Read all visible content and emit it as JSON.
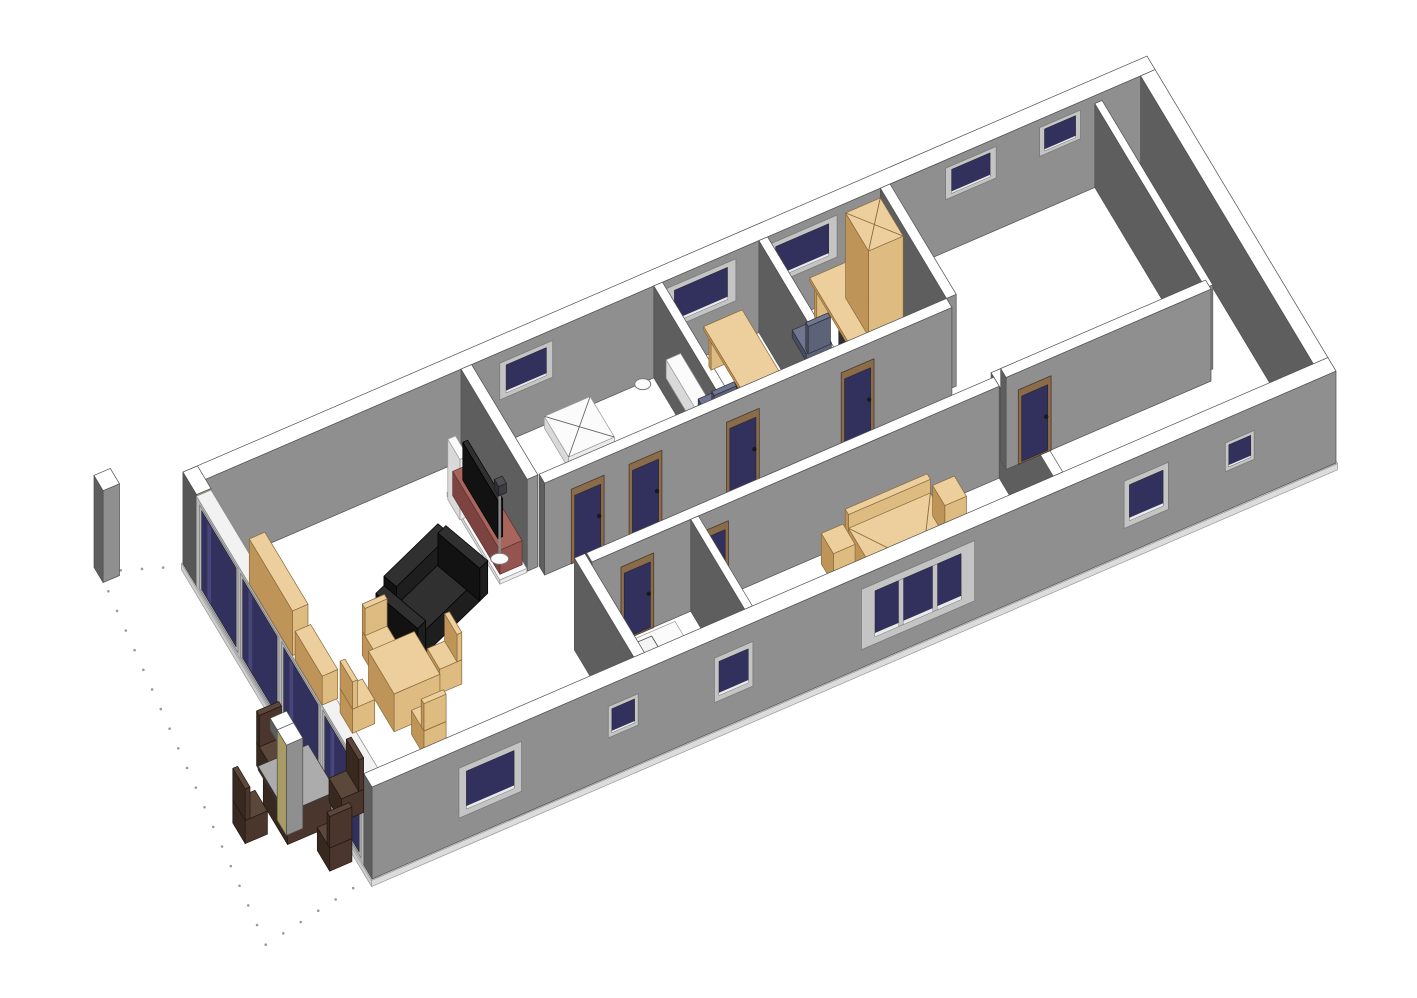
{
  "meta": {
    "title": "3D Axonometric Floor Plan View",
    "background": "#ffffff"
  },
  "projection": {
    "origin": [
      183,
      564
    ],
    "ux": [
      48.2,
      -20.8
    ],
    "uy": [
      27,
      45
    ],
    "uz": 52.5
  },
  "palette": {
    "wall": {
      "t": "#ffffff",
      "f": "#8f8f8f",
      "s": "#5e5e5e",
      "e": "#4f4f4f"
    },
    "glassFrame": {
      "t": "#f2f2f2",
      "f": "#c2c2c2",
      "s": "#b6b6b6",
      "e": "#8a8a8a"
    },
    "floorp": {
      "t": "#ffffff",
      "f": "#dcdcdc",
      "s": "#cccccc",
      "e": "#999999"
    },
    "tan": {
      "t": "#eccf9d",
      "f": "#debb80",
      "s": "#bf9458",
      "e": "#8a6a3a"
    },
    "white": {
      "t": "#fbfbfb",
      "f": "#ebebeb",
      "s": "#d9d9d9",
      "e": "#9a9a9a"
    },
    "red": {
      "t": "#a8655c",
      "f": "#95544d",
      "s": "#7d4340",
      "e": "#5e312e"
    },
    "blackp": {
      "t": "#303030",
      "f": "#1e1e1e",
      "s": "#121212",
      "e": "#000000"
    },
    "wood": {
      "t": "#5c473b",
      "f": "#4a362c",
      "s": "#372820",
      "e": "#241812"
    },
    "woodTop": {
      "t": "#acacac",
      "f": "#4a362c",
      "s": "#372820",
      "e": "#3a3a3a"
    },
    "chairc": {
      "t": "#707690",
      "f": "#5c6278",
      "s": "#474c5e",
      "e": "#2c2f3a"
    },
    "dark": {
      "t": "#4e4e54",
      "f": "#3c3c42",
      "s": "#2e2e33",
      "e": "#1e1e22"
    },
    "pillarTan": {
      "t": "#ffffff",
      "f": "#a89b63",
      "s": "#565656",
      "e": "#4f4f4f"
    },
    "colTan": {
      "t": "#ffffff",
      "f": "#8f8f8f",
      "s": "#a89b63",
      "e": "#4f4f4f"
    }
  },
  "materials": {
    "glass": "#32305c",
    "glassHi": "#474579",
    "windowFrame": "#c4c4c4",
    "windowFrameEdge": "#7a7a7a",
    "sill": "#e9e9e9",
    "doorFrame": "#8a6b4a",
    "doorFrameEdge": "#4a3a28",
    "doorPanel": "#32305c",
    "handle": "#1a1a1a",
    "dot": "#9a9a9a",
    "topLine": "#8a6a3a",
    "showerLine": "#666666",
    "chairBase": "#2e2e2e"
  },
  "scene": [
    {
      "t": "dots",
      "n": "terrace-boundary",
      "pts": [
        [
          0,
          0.05
        ],
        [
          -1.45,
          -0.5
        ],
        [
          -2.4,
          7.35
        ],
        [
          0,
          6.95
        ]
      ]
    },
    {
      "t": "box",
      "n": "floor-slab",
      "p": [
        -0.02,
        -0.02,
        20.04,
        7.04,
        -0.12,
        0.12
      ],
      "c": "floorp"
    },
    {
      "t": "box",
      "n": "back-wall",
      "p": [
        0,
        0,
        20,
        0.3,
        0,
        1.75
      ],
      "c": "wall"
    },
    {
      "t": "win",
      "n": "window-bathroom",
      "p": [
        6.4,
        1.1,
        0.85,
        0.7
      ],
      "y": 0.305
    },
    {
      "t": "win",
      "n": "window-bedroom-1",
      "p": [
        9.85,
        1.45,
        0.8,
        0.8
      ],
      "y": 0.305
    },
    {
      "t": "win",
      "n": "window-bedroom-2",
      "p": [
        11.95,
        1.45,
        0.8,
        0.8
      ],
      "y": 0.305
    },
    {
      "t": "win",
      "n": "window-garage-rear-1",
      "p": [
        15.65,
        1.05,
        1.0,
        0.6
      ],
      "y": 0.305
    },
    {
      "t": "win",
      "n": "window-garage-rear-2",
      "p": [
        17.6,
        0.85,
        1.05,
        0.55
      ],
      "y": 0.305
    },
    {
      "t": "box",
      "n": "right-end-wall",
      "p": [
        19.7,
        0.3,
        0.3,
        6.4,
        0,
        1.75
      ],
      "c": "wall"
    },
    {
      "t": "box",
      "n": "left-corner-pillar",
      "p": [
        0,
        0,
        0.3,
        0.5,
        0,
        1.75
      ],
      "c": "pillarTan"
    },
    {
      "t": "box",
      "n": "left-glass-wall",
      "p": [
        0,
        0.5,
        0.3,
        6.2,
        0,
        1.72
      ],
      "c": "glassFrame"
    },
    {
      "t": "glass",
      "n": "sliding-glass-panel-1",
      "p": [
        0.62,
        1.42,
        0.06,
        1.6
      ],
      "x": -0.002
    },
    {
      "t": "glass",
      "n": "sliding-glass-panel-2",
      "p": [
        2.14,
        1.42,
        0.06,
        1.6
      ],
      "x": -0.002
    },
    {
      "t": "glass",
      "n": "sliding-glass-panel-3",
      "p": [
        3.66,
        1.42,
        0.06,
        1.6
      ],
      "x": -0.002
    },
    {
      "t": "glass",
      "n": "sliding-glass-panel-4",
      "p": [
        5.18,
        1.42,
        0.06,
        1.6
      ],
      "x": -0.002
    },
    {
      "t": "box",
      "n": "living-sideboard-1",
      "p": [
        0.9,
        0.85,
        0.32,
        1.6,
        0,
        0.85
      ],
      "c": "tan"
    },
    {
      "t": "box",
      "n": "living-sideboard-2",
      "p": [
        0.9,
        2.55,
        0.32,
        1.0,
        0,
        0.55
      ],
      "c": "tan"
    },
    {
      "t": "box",
      "n": "shower-tray",
      "p": [
        7.3,
        0.35,
        0.95,
        0.9,
        0,
        0.22
      ],
      "c": "white",
      "top": "cross"
    },
    {
      "t": "box",
      "n": "toilet-tank",
      "p": [
        7.75,
        2.42,
        0.42,
        0.2,
        0,
        0.52
      ],
      "c": "white"
    },
    {
      "t": "ell",
      "n": "toilet-bowl",
      "p": [
        7.95,
        2.15,
        0.3,
        10,
        6.5
      ]
    },
    {
      "t": "ell",
      "n": "bathroom-sink",
      "p": [
        8.95,
        1.05,
        0.78,
        8,
        5.5
      ]
    },
    {
      "t": "box",
      "n": "wall-bath-bedroom1",
      "p": [
        9.6,
        0.3,
        0.18,
        2.45,
        0,
        1.75
      ],
      "c": "wall"
    },
    {
      "t": "box",
      "n": "bedroom1-cabinet",
      "p": [
        9.8,
        0.4,
        0.3,
        1.05,
        0,
        0.35
      ],
      "c": "white"
    },
    {
      "t": "box",
      "n": "bedroom1-desk-panel",
      "p": [
        10.62,
        0.52,
        0.62,
        0.08,
        0,
        0.66
      ],
      "c": "tan"
    },
    {
      "t": "box",
      "n": "bedroom1-desk-drawers",
      "p": [
        10.62,
        1.5,
        0.62,
        0.5,
        0,
        0.66
      ],
      "c": "dark"
    },
    {
      "t": "box",
      "n": "bedroom1-desk-top",
      "p": [
        10.55,
        0.45,
        0.8,
        1.6,
        0.66,
        0.07
      ],
      "c": "tan"
    },
    {
      "t": "ochair",
      "n": "bedroom1-office-chair",
      "p": [
        9.82,
        1.55
      ]
    },
    {
      "t": "box",
      "n": "bedroom1-dresser",
      "p": [
        10.62,
        2.1,
        0.55,
        0.55,
        0,
        0.85
      ],
      "c": "tan",
      "top": "cross"
    },
    {
      "t": "box",
      "n": "wall-bedroom1-bedroom2",
      "p": [
        11.78,
        0.3,
        0.18,
        2.45,
        0,
        1.75
      ],
      "c": "wall"
    },
    {
      "t": "box",
      "n": "bedroom2-desk-panel",
      "p": [
        12.85,
        0.45,
        0.62,
        0.08,
        0,
        0.66
      ],
      "c": "tan"
    },
    {
      "t": "box",
      "n": "bedroom2-desk-drawers",
      "p": [
        12.85,
        1.35,
        0.62,
        0.5,
        0,
        0.66
      ],
      "c": "dark"
    },
    {
      "t": "box",
      "n": "bedroom2-desk-top",
      "p": [
        12.78,
        0.4,
        0.78,
        1.5,
        0.66,
        0.07
      ],
      "c": "tan"
    },
    {
      "t": "ochair",
      "n": "bedroom2-office-chair",
      "p": [
        12.05,
        1.05
      ]
    },
    {
      "t": "box",
      "n": "bedroom2-bed",
      "p": [
        12.15,
        1.95,
        1.5,
        0.72,
        0,
        0.4
      ],
      "c": "white"
    },
    {
      "t": "box",
      "n": "bedroom2-bed-headboard",
      "p": [
        13.5,
        1.95,
        0.15,
        0.72,
        0.4,
        0.22
      ],
      "c": "white"
    },
    {
      "t": "box",
      "n": "wall-bedroom2-garage",
      "p": [
        14.3,
        0.3,
        0.2,
        2.45,
        0,
        1.75
      ],
      "c": "wall"
    },
    {
      "t": "box",
      "n": "wall-entry-left",
      "p": [
        14.3,
        4.4,
        0.2,
        2.3,
        0,
        1.75
      ],
      "c": "wall"
    },
    {
      "t": "box",
      "n": "bedroom2-wardrobe",
      "p": [
        13.55,
        0.35,
        0.72,
        0.85,
        0,
        1.62
      ],
      "c": "tan",
      "top": "cross"
    },
    {
      "t": "box",
      "n": "garage-inner-wall",
      "p": [
        18.75,
        0.3,
        0.15,
        4.1,
        0,
        1.6
      ],
      "c": "wall"
    },
    {
      "t": "box",
      "n": "hallway-wall-rear",
      "p": [
        5.85,
        2.75,
        8.45,
        0.2,
        0,
        1.75
      ],
      "c": "wall"
    },
    {
      "t": "door",
      "n": "door-living",
      "p": [
        6.4,
        0.68,
        0,
        1.42
      ],
      "y": 2.956
    },
    {
      "t": "door",
      "n": "door-bathroom",
      "p": [
        7.6,
        0.68,
        0,
        1.42
      ],
      "y": 2.956
    },
    {
      "t": "door",
      "n": "door-bedroom-1",
      "p": [
        9.62,
        0.68,
        0,
        1.42
      ],
      "y": 2.956
    },
    {
      "t": "door",
      "n": "door-bedroom-2",
      "p": [
        12.0,
        0.68,
        0,
        1.42
      ],
      "y": 2.956
    },
    {
      "t": "box",
      "n": "hallway-wall-front",
      "p": [
        5.85,
        4.5,
        8.45,
        0.2,
        0,
        1.75
      ],
      "c": "wall"
    },
    {
      "t": "door",
      "n": "door-kitchen",
      "p": [
        6.45,
        0.68,
        0,
        1.42
      ],
      "y": 4.706
    },
    {
      "t": "door",
      "n": "door-master-bedroom",
      "p": [
        8.0,
        0.68,
        0,
        1.42
      ],
      "y": 4.706
    },
    {
      "t": "box",
      "n": "entry-wall",
      "p": [
        14.5,
        4.4,
        4.25,
        0.2,
        0,
        1.75
      ],
      "c": "wall"
    },
    {
      "t": "door",
      "n": "door-garage",
      "p": [
        14.75,
        0.68,
        0,
        1.42
      ],
      "y": 4.606
    },
    {
      "t": "box",
      "n": "wall-kitchen-master",
      "p": [
        7.9,
        4.7,
        0.16,
        2.0,
        0,
        1.75
      ],
      "c": "wall"
    },
    {
      "t": "box",
      "n": "master-bed-headboard",
      "p": [
        11.05,
        4.8,
        1.7,
        0.12,
        0,
        0.78
      ],
      "c": "tan"
    },
    {
      "t": "box",
      "n": "master-bed",
      "p": [
        11.05,
        4.92,
        1.7,
        1.95,
        0,
        0.52
      ],
      "c": "tan",
      "top": "bed"
    },
    {
      "t": "box",
      "n": "nightstand-left",
      "p": [
        10.52,
        4.86,
        0.45,
        0.45,
        0,
        0.58
      ],
      "c": "tan"
    },
    {
      "t": "box",
      "n": "nightstand-right",
      "p": [
        12.83,
        4.86,
        0.45,
        0.45,
        0,
        0.58
      ],
      "c": "tan"
    },
    {
      "t": "box",
      "n": "kitchen-counter",
      "p": [
        5.95,
        5.28,
        1.3,
        0.58,
        0,
        0.56
      ],
      "c": "white"
    },
    {
      "t": "sink",
      "n": "kitchen-sink",
      "p": [
        6.12,
        5.36,
        0.6,
        0.42,
        0.56
      ]
    },
    {
      "t": "box",
      "n": "wall-living-rear-seg",
      "p": [
        5.6,
        0.3,
        0.22,
        2.45,
        0,
        1.75
      ],
      "c": "wall"
    },
    {
      "t": "box",
      "n": "wall-living-front-seg",
      "p": [
        5.6,
        4.5,
        0.22,
        2.2,
        0,
        1.75
      ],
      "c": "wall"
    },
    {
      "t": "box",
      "n": "tv-base",
      "p": [
        5.02,
        0.82,
        0.56,
        1.95,
        0,
        0.08
      ],
      "c": "white"
    },
    {
      "t": "box",
      "n": "tv-speaker",
      "p": [
        5.0,
        0.88,
        0.16,
        0.45,
        0,
        1.15
      ],
      "c": "white"
    },
    {
      "t": "box",
      "n": "tv-cabinet",
      "p": [
        5.08,
        0.92,
        0.46,
        1.75,
        0.08,
        0.46
      ],
      "c": "red"
    },
    {
      "t": "box",
      "n": "tv-screen",
      "p": [
        5.16,
        1.15,
        0.1,
        1.3,
        0.54,
        0.72
      ],
      "c": "blackp"
    },
    {
      "t": "pole",
      "n": "floor-lamp-pole",
      "p": [
        5.27,
        2.32,
        1.3
      ]
    },
    {
      "t": "ell",
      "n": "floor-lamp-base",
      "p": [
        5.27,
        2.32,
        0,
        9,
        5.5
      ]
    },
    {
      "t": "box",
      "n": "floor-lamp-head",
      "p": [
        5.2,
        2.25,
        0.16,
        0.16,
        1.3,
        0.18
      ],
      "c": "dark"
    },
    {
      "t": "box",
      "n": "sofa-back",
      "p": [
        2.9,
        2.2,
        1.5,
        0.3,
        0,
        0.8
      ],
      "c": "blackp",
      "rot": -20,
      "pivot": [
        3.65,
        2.7
      ]
    },
    {
      "t": "box",
      "n": "sofa-seat",
      "p": [
        2.9,
        2.5,
        1.5,
        0.7,
        0,
        0.45
      ],
      "c": "blackp",
      "rot": -20,
      "pivot": [
        3.65,
        2.7
      ]
    },
    {
      "t": "box",
      "n": "sofa-arm-left",
      "p": [
        2.68,
        2.2,
        0.22,
        1.0,
        0,
        0.62
      ],
      "c": "blackp",
      "rot": -20,
      "pivot": [
        3.65,
        2.7
      ]
    },
    {
      "t": "box",
      "n": "sofa-arm-right",
      "p": [
        4.4,
        2.2,
        0.22,
        1.0,
        0,
        0.62
      ],
      "c": "blackp",
      "rot": -20,
      "pivot": [
        3.65,
        2.7
      ]
    },
    {
      "t": "chair",
      "n": "dining-chair-north",
      "p": [
        2.05,
        2.98
      ],
      "dir": "n",
      "c": "tan"
    },
    {
      "t": "chair",
      "n": "dining-chair-east",
      "p": [
        2.95,
        3.78
      ],
      "dir": "e",
      "c": "tan"
    },
    {
      "t": "box",
      "n": "dining-table",
      "p": [
        1.82,
        3.62,
        0.95,
        0.95,
        0,
        0.72
      ],
      "c": "tan"
    },
    {
      "t": "chair",
      "n": "dining-chair-west",
      "p": [
        1.12,
        3.82
      ],
      "dir": "w",
      "c": "tan"
    },
    {
      "t": "chair",
      "n": "dining-chair-south",
      "p": [
        2.08,
        4.75
      ],
      "dir": "s",
      "c": "tan"
    },
    {
      "t": "box",
      "n": "front-wall",
      "p": [
        0,
        6.7,
        20,
        0.3,
        0,
        1.75
      ],
      "c": "wall"
    },
    {
      "t": "win",
      "n": "window-living-front",
      "p": [
        1.8,
        1.3,
        0.45,
        0.95
      ],
      "y": 7.006
    },
    {
      "t": "win",
      "n": "window-living-front-2",
      "p": [
        4.9,
        0.62,
        0.75,
        0.6
      ],
      "y": 7.006
    },
    {
      "t": "win",
      "n": "window-kitchen-front",
      "p": [
        7.1,
        0.8,
        0.55,
        0.85
      ],
      "y": 7.006
    },
    {
      "t": "win",
      "n": "window-master-triple",
      "p": [
        10.15,
        2.35,
        0.35,
        1.15
      ],
      "y": 7.006,
      "k": 3
    },
    {
      "t": "win",
      "n": "window-entry-1",
      "p": [
        15.6,
        0.92,
        0.5,
        0.9
      ],
      "y": 7.006
    },
    {
      "t": "win",
      "n": "window-entry-2",
      "p": [
        17.7,
        0.6,
        0.75,
        0.55
      ],
      "y": 7.006
    },
    {
      "t": "box",
      "n": "terrace-column-rear",
      "p": [
        -1.5,
        -0.62,
        0.34,
        0.34,
        0,
        1.75
      ],
      "c": "wall"
    },
    {
      "t": "chair",
      "n": "patio-chair-north",
      "p": [
        -0.78,
        4.12
      ],
      "dir": "n",
      "c": "wood"
    },
    {
      "t": "chair",
      "n": "patio-chair-west",
      "p": [
        -1.74,
        4.95
      ],
      "dir": "w",
      "c": "wood"
    },
    {
      "t": "box",
      "n": "patio-table-base",
      "p": [
        -1.05,
        4.85,
        0.9,
        0.9,
        0,
        0.62
      ],
      "c": "wood"
    },
    {
      "t": "box",
      "n": "patio-table-top",
      "p": [
        -1.12,
        4.78,
        1.04,
        1.04,
        0.62,
        0.07
      ],
      "c": "woodTop"
    },
    {
      "t": "chair",
      "n": "patio-chair-east",
      "p": [
        0.06,
        5.3
      ],
      "dir": "e",
      "c": "wood"
    },
    {
      "t": "chair",
      "n": "patio-chair-south",
      "p": [
        -0.62,
        6.08
      ],
      "dir": "s",
      "c": "wood"
    },
    {
      "t": "box",
      "n": "terrace-column-front-cap",
      "p": [
        -0.98,
        4.98,
        0.34,
        0.26,
        1.5,
        0.22
      ],
      "c": "wall"
    },
    {
      "t": "box",
      "n": "terrace-column-front",
      "p": [
        -0.98,
        5.24,
        0.34,
        0.34,
        0,
        1.72
      ],
      "c": "colTan"
    }
  ]
}
